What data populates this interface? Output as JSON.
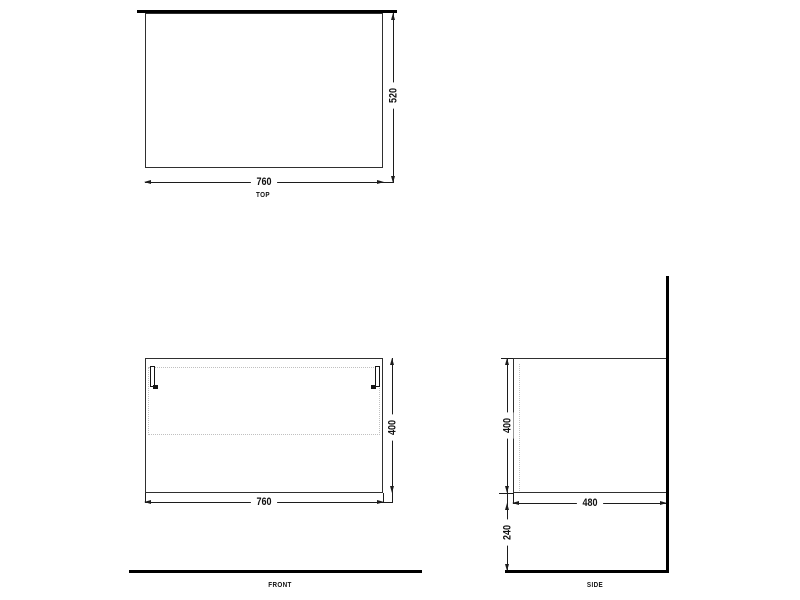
{
  "views": {
    "top": {
      "label": "TOP",
      "width_dim": "760",
      "depth_dim": "520"
    },
    "front": {
      "label": "FRONT",
      "width_dim": "760",
      "height_dim": "400"
    },
    "side": {
      "label": "SIDE",
      "depth_dim": "480",
      "height_dim": "400",
      "floor_clearance_dim": "240"
    }
  },
  "colors": {
    "background": "#ffffff",
    "outline": "#2f2f2f",
    "heavy_line": "#000000",
    "dimension_line": "#1c1c1c",
    "dashed_line": "#c0c0c0",
    "text": "#111111"
  }
}
